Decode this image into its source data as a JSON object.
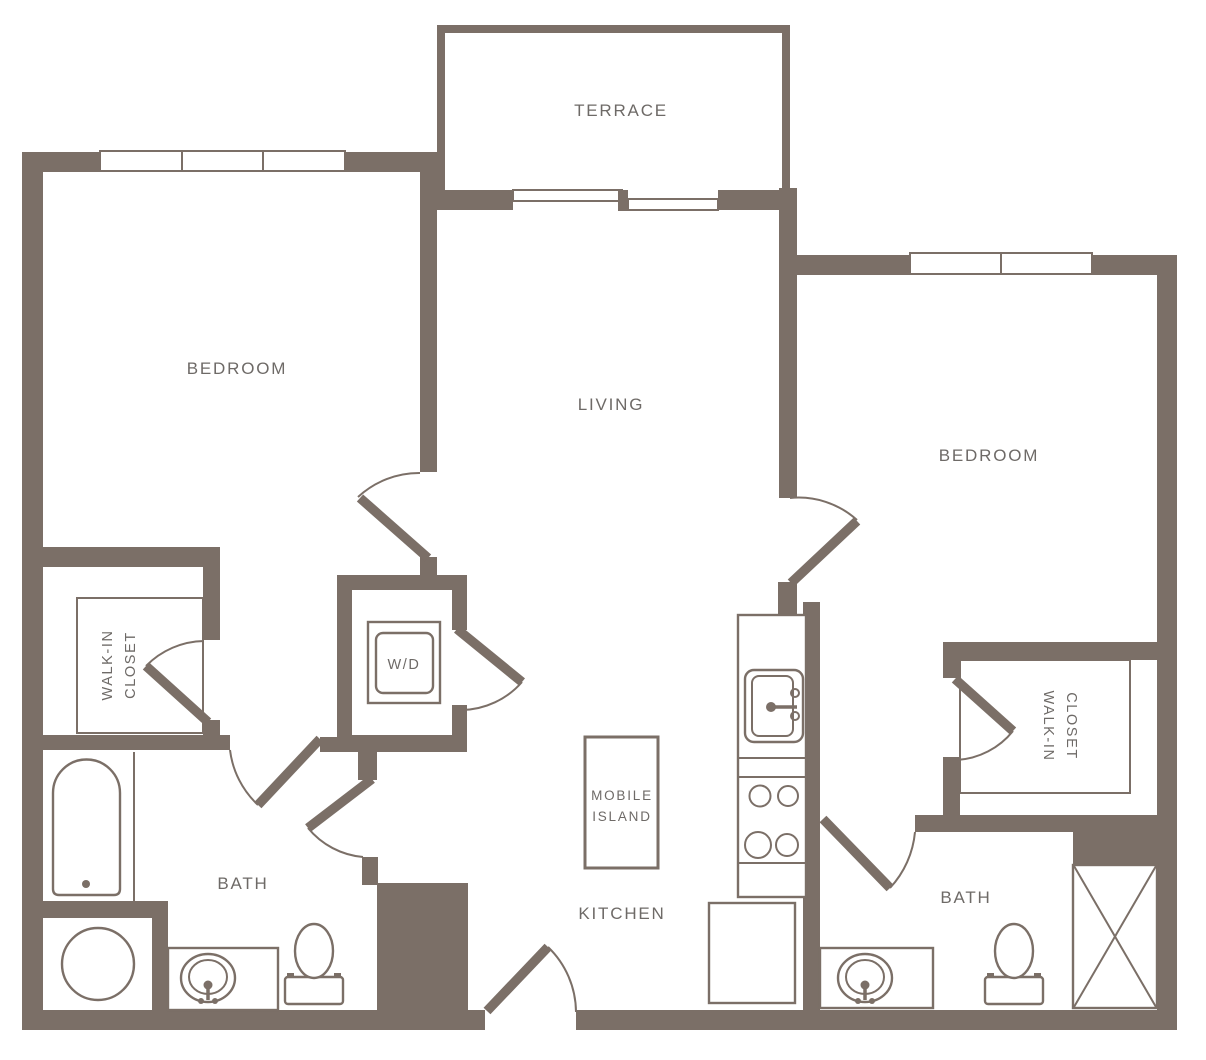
{
  "title": "Two Bedroom Apartment Floor Plan",
  "colors": {
    "wall": "#7b6f67",
    "fixture_line": "#7b6f67",
    "label_text": "#6e6a67",
    "background": "#ffffff"
  },
  "rooms": {
    "terrace": "TERRACE",
    "bedroom_left": "BEDROOM",
    "bedroom_right": "BEDROOM",
    "living": "LIVING",
    "kitchen": "KITCHEN",
    "bath_left": "BATH",
    "bath_right": "BATH",
    "closet_left_line1": "WALK-IN",
    "closet_left_line2": "CLOSET",
    "closet_right_line1": "WALK-IN",
    "closet_right_line2": "CLOSET"
  },
  "fixtures": {
    "washer_dryer": "W/D",
    "mobile_island_line1": "MOBILE",
    "mobile_island_line2": "ISLAND"
  }
}
